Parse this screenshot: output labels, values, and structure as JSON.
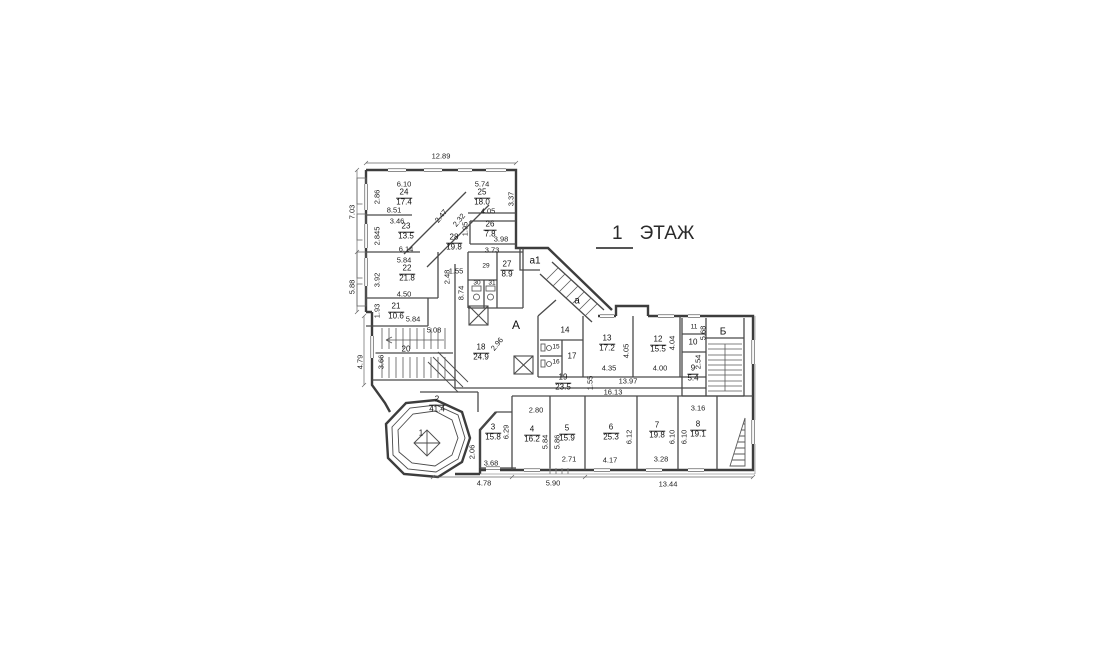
{
  "title": {
    "number": "1",
    "word": "ЭТАЖ"
  },
  "rooms": [
    {
      "number": "1",
      "area": ""
    },
    {
      "number": "2",
      "area": "41.4"
    },
    {
      "number": "3",
      "area": "15.8"
    },
    {
      "number": "4",
      "area": "16.2"
    },
    {
      "number": "5",
      "area": "15.9"
    },
    {
      "number": "6",
      "area": "25.3"
    },
    {
      "number": "7",
      "area": "19.8"
    },
    {
      "number": "8",
      "area": "19.1"
    },
    {
      "number": "9",
      "area": "5.4"
    },
    {
      "number": "10",
      "area": ""
    },
    {
      "number": "11",
      "area": ""
    },
    {
      "number": "12",
      "area": "15.5"
    },
    {
      "number": "13",
      "area": "17.2"
    },
    {
      "number": "14",
      "area": ""
    },
    {
      "number": "15",
      "area": ""
    },
    {
      "number": "16",
      "area": ""
    },
    {
      "number": "17",
      "area": ""
    },
    {
      "number": "18",
      "area": "24.9"
    },
    {
      "number": "19",
      "area": "23.5"
    },
    {
      "number": "20",
      "area": ""
    },
    {
      "number": "21",
      "area": "10.6"
    },
    {
      "number": "22",
      "area": "21.8"
    },
    {
      "number": "23",
      "area": "13.5"
    },
    {
      "number": "24",
      "area": "17.4"
    },
    {
      "number": "25",
      "area": "18.0"
    },
    {
      "number": "26",
      "area": "7.8"
    },
    {
      "number": "27",
      "area": "8.9"
    },
    {
      "number": "28",
      "area": "19.8"
    },
    {
      "number": "29",
      "area": ""
    },
    {
      "number": "30",
      "area": ""
    },
    {
      "number": "31",
      "area": ""
    }
  ],
  "letters": {
    "A": "А",
    "B": "Б",
    "a": "а",
    "a1": "а1"
  },
  "dims": [
    "12.89",
    "7.03",
    "5.88",
    "4.79",
    "6.10",
    "2.86",
    "8.51",
    "5.74",
    "3.37",
    "4.05",
    "3.46",
    "2.845",
    "6.14",
    "2.47",
    "2.32",
    "1.95",
    "3.98",
    "3.73",
    "5.84",
    "3.92",
    "2.48",
    "4.50",
    "1.55",
    "8.74",
    "1.93",
    "5.84",
    "5.08",
    "3.66",
    "2.96",
    "2.06",
    "3.68",
    "4.78",
    "6.29",
    "2.80",
    "5.84",
    "5.86",
    "2.71",
    "5.90",
    "6.12",
    "4.17",
    "6.10",
    "3.28",
    "6.10",
    "3.16",
    "13.44",
    "4.05",
    "4.35",
    "4.04",
    "4.00",
    "13.97",
    "16.13",
    "1.55",
    "5.68",
    "2.54"
  ],
  "drawing": {
    "wall_color": "#3d3d3d",
    "paper_color": "#ffffff"
  }
}
